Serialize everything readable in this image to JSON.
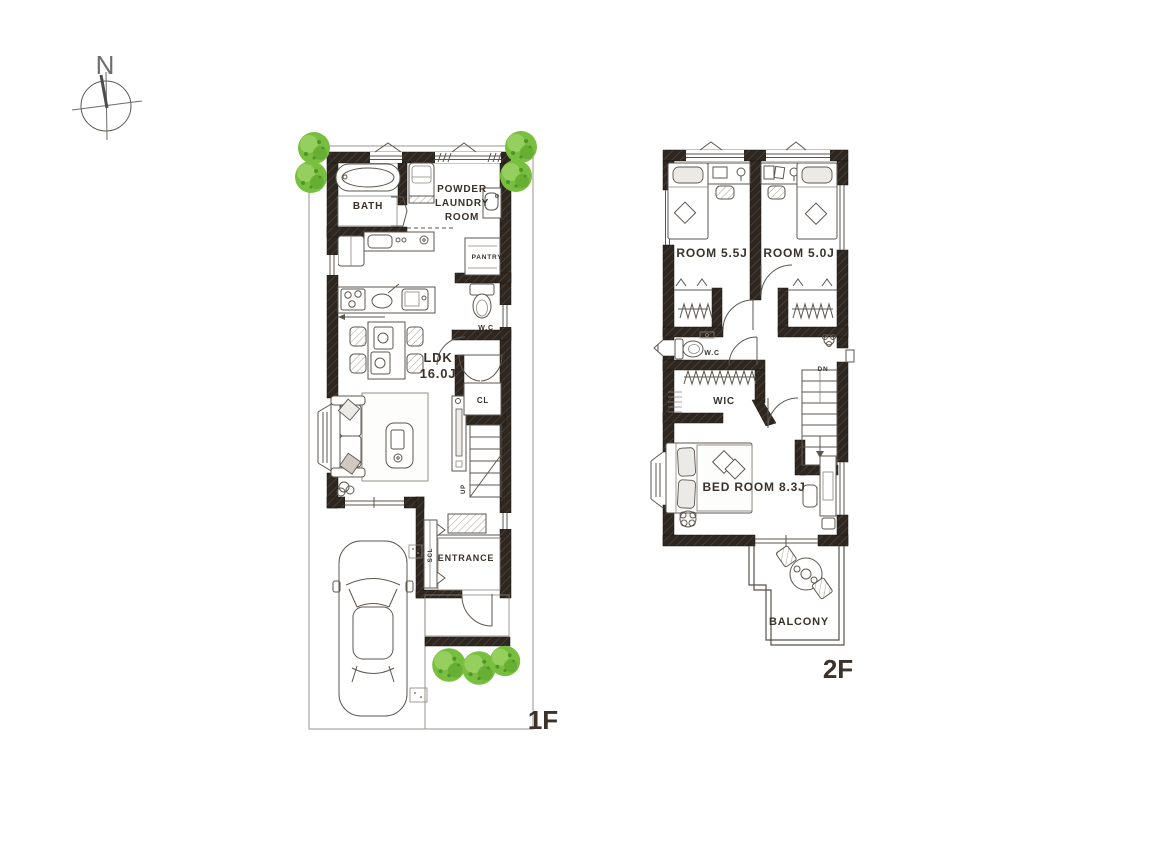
{
  "compass": {
    "north": "N"
  },
  "floor1": {
    "label": "1F",
    "bath": "BATH",
    "powder_line1": "POWDER",
    "powder_line2": "LAUNDRY",
    "powder_line3": "ROOM",
    "pantry": "PANTRY",
    "wc": "W.C",
    "ldk_line1": "LDK",
    "ldk_line2": "16.0J",
    "cl": "CL",
    "up": "UP",
    "scl": "SCL",
    "entrance": "ENTRANCE"
  },
  "floor2": {
    "label": "2F",
    "room_a": "ROOM 5.5J",
    "room_b": "ROOM 5.0J",
    "wc": "W.C",
    "wic": "WIC",
    "dn": "DN",
    "bedroom": "BED ROOM 8.3J",
    "balcony": "BALCONY"
  },
  "colors": {
    "wall": "#2e2620",
    "line": "#5d564f",
    "text": "#3a322b",
    "tree": "#79bf3f",
    "tree_dark": "#4f9527",
    "tree_light": "#9ad264",
    "background": "#ffffff"
  }
}
